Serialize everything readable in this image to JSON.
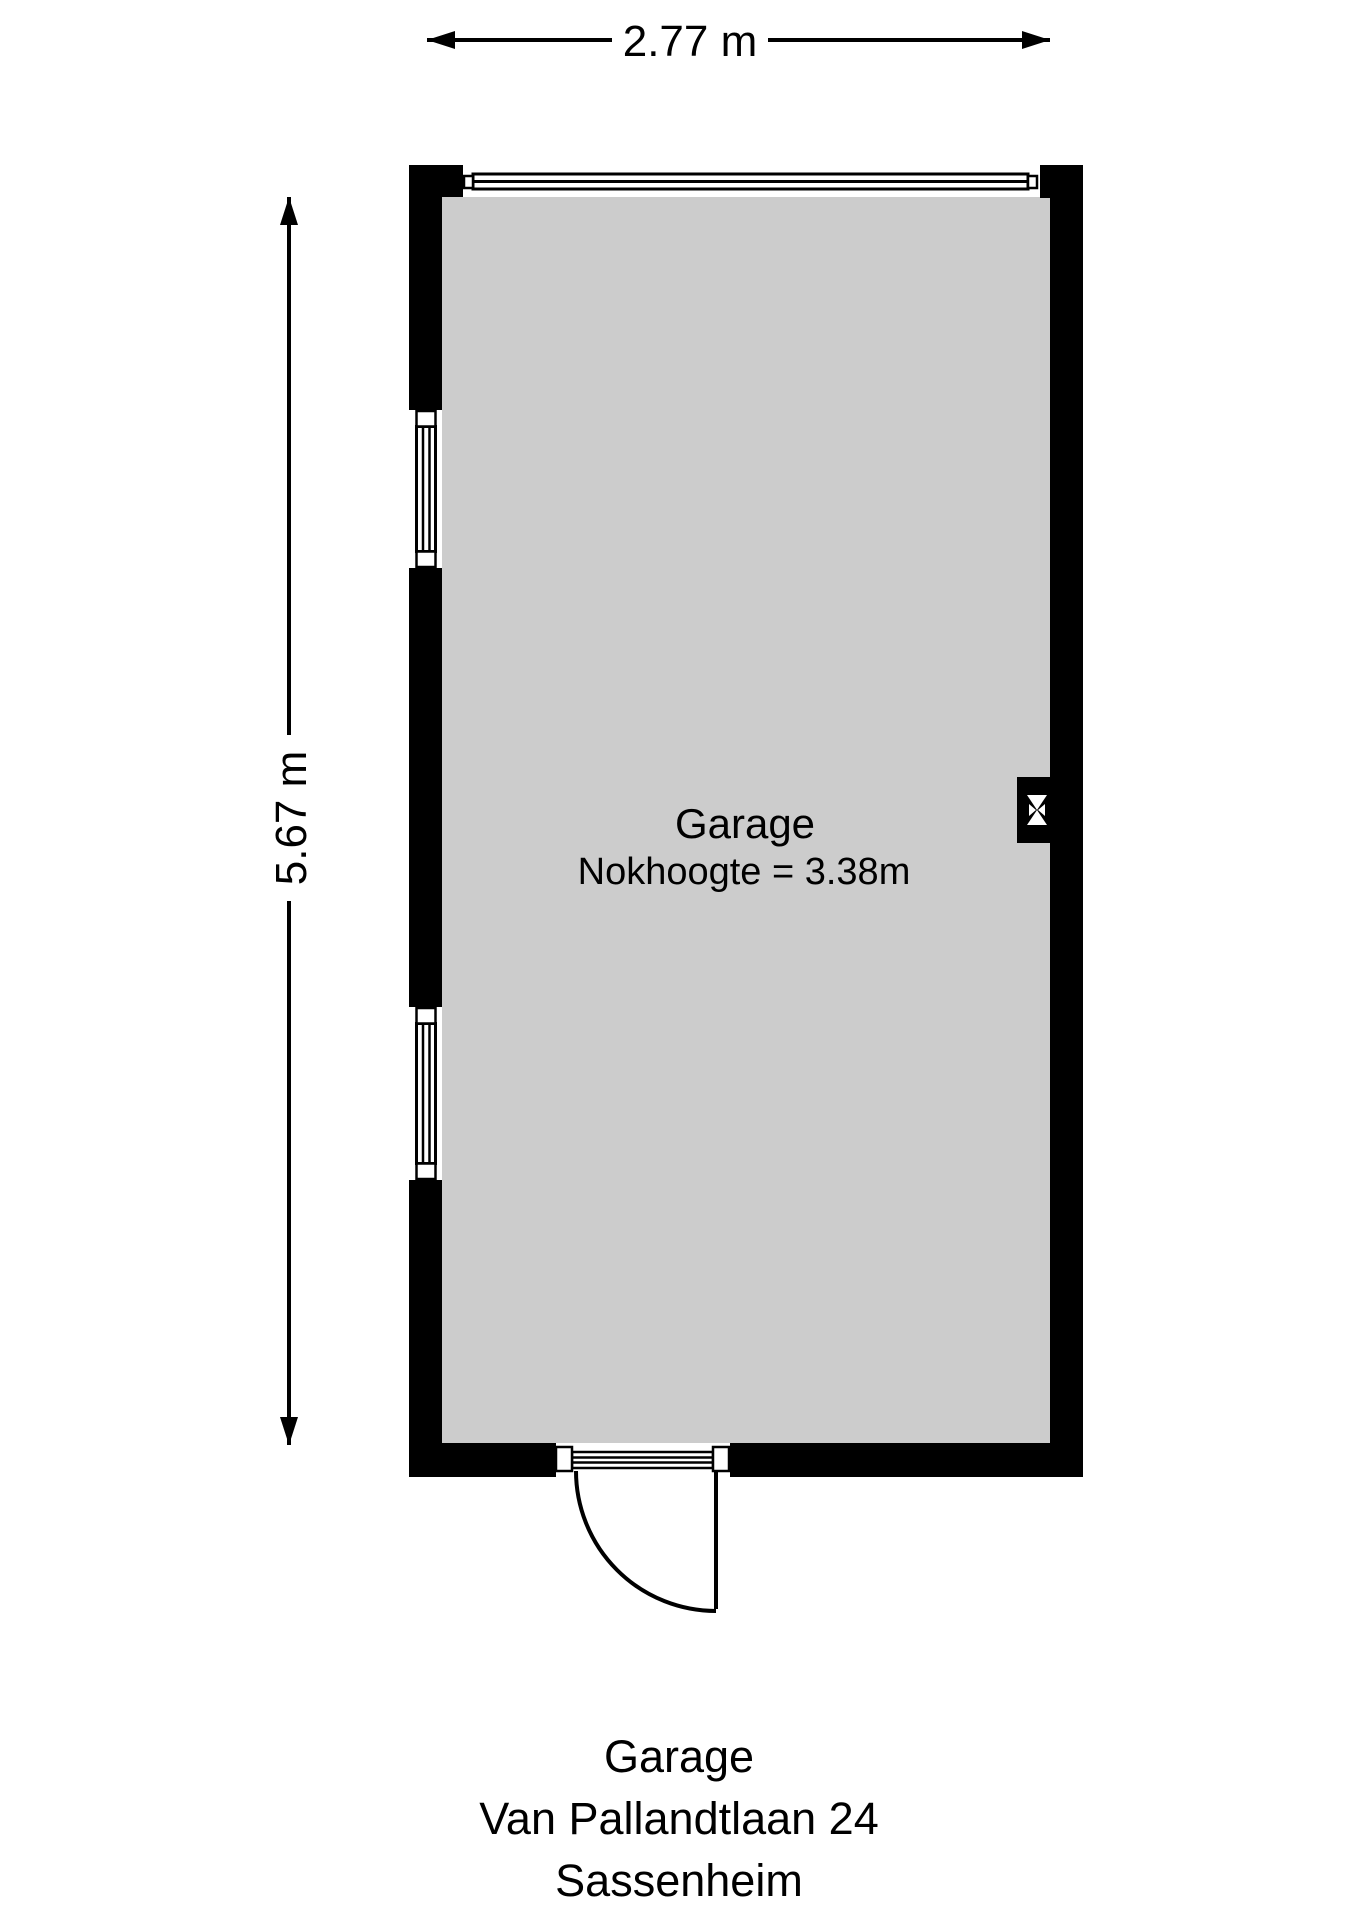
{
  "dimensions": {
    "width_label": "2.77 m",
    "height_label": "5.67 m"
  },
  "room": {
    "name": "Garage",
    "ridge_height": "Nokhoogte = 3.38m"
  },
  "caption": {
    "room": "Garage",
    "address": "Van Pallandtlaan 24",
    "city": "Sassenheim"
  },
  "colors": {
    "wall": "#000000",
    "floor": "#cccccc",
    "background": "#ffffff",
    "line": "#000000"
  }
}
